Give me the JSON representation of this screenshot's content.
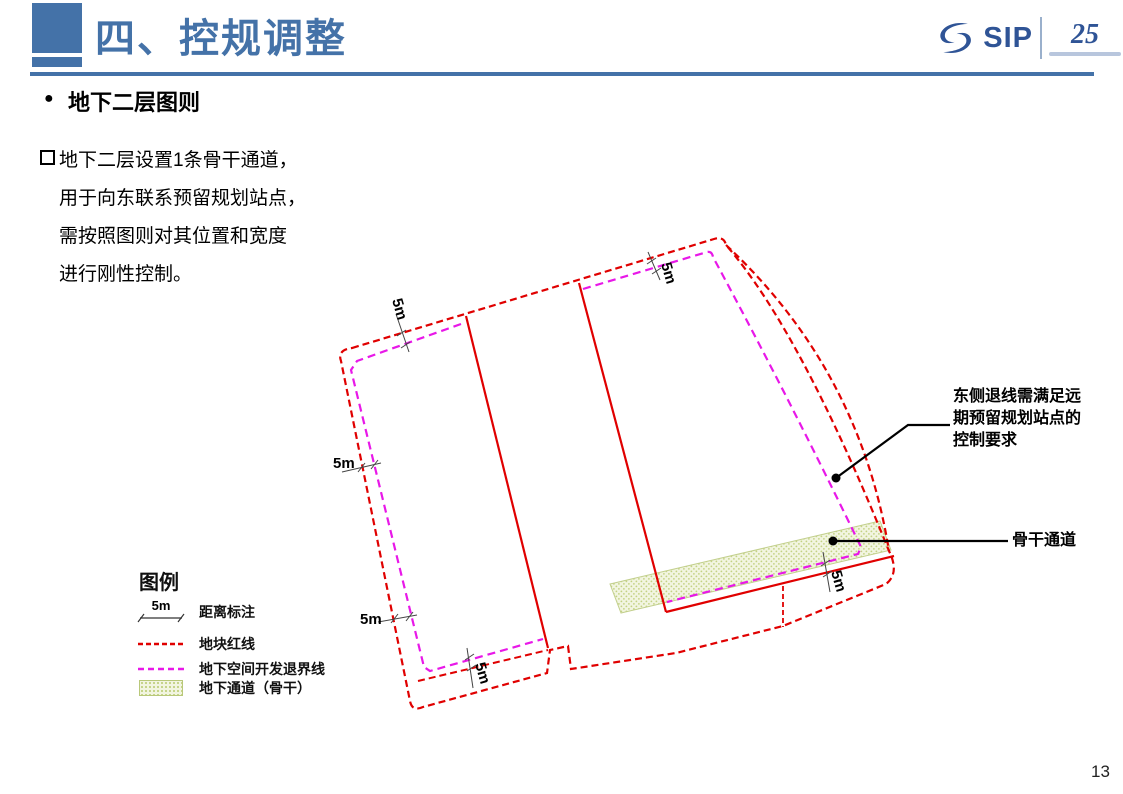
{
  "header": {
    "title": "四、控规调整"
  },
  "logo": {
    "sip": "SIP",
    "anniv": "25"
  },
  "section_title": "地下二层图则",
  "body_lines": [
    "地下二层设置1条骨干通道，",
    "用于向东联系预留规划站点，",
    "需按照图则对其位置和宽度",
    "进行刚性控制。"
  ],
  "diagram": {
    "dim_label": "5m"
  },
  "annotations": {
    "east": {
      "lines": [
        "东侧退线需满足远",
        "期预留规划站点的",
        "控制要求"
      ]
    },
    "trunk": {
      "label": "骨干通道"
    }
  },
  "legend": {
    "title": "图例",
    "dim_symbol_label": "5m",
    "items": [
      {
        "label": "距离标注"
      },
      {
        "label": "地块红线"
      },
      {
        "label": "地下空间开发退界线"
      },
      {
        "label": "地下通道（骨干）"
      }
    ]
  },
  "page_number": "13",
  "colors": {
    "accent": "#4472a8",
    "red_line": "#e00000",
    "magenta_line": "#e818e8",
    "passage_fill": "#f2f5e0",
    "logo_blue": "#2f5496"
  }
}
